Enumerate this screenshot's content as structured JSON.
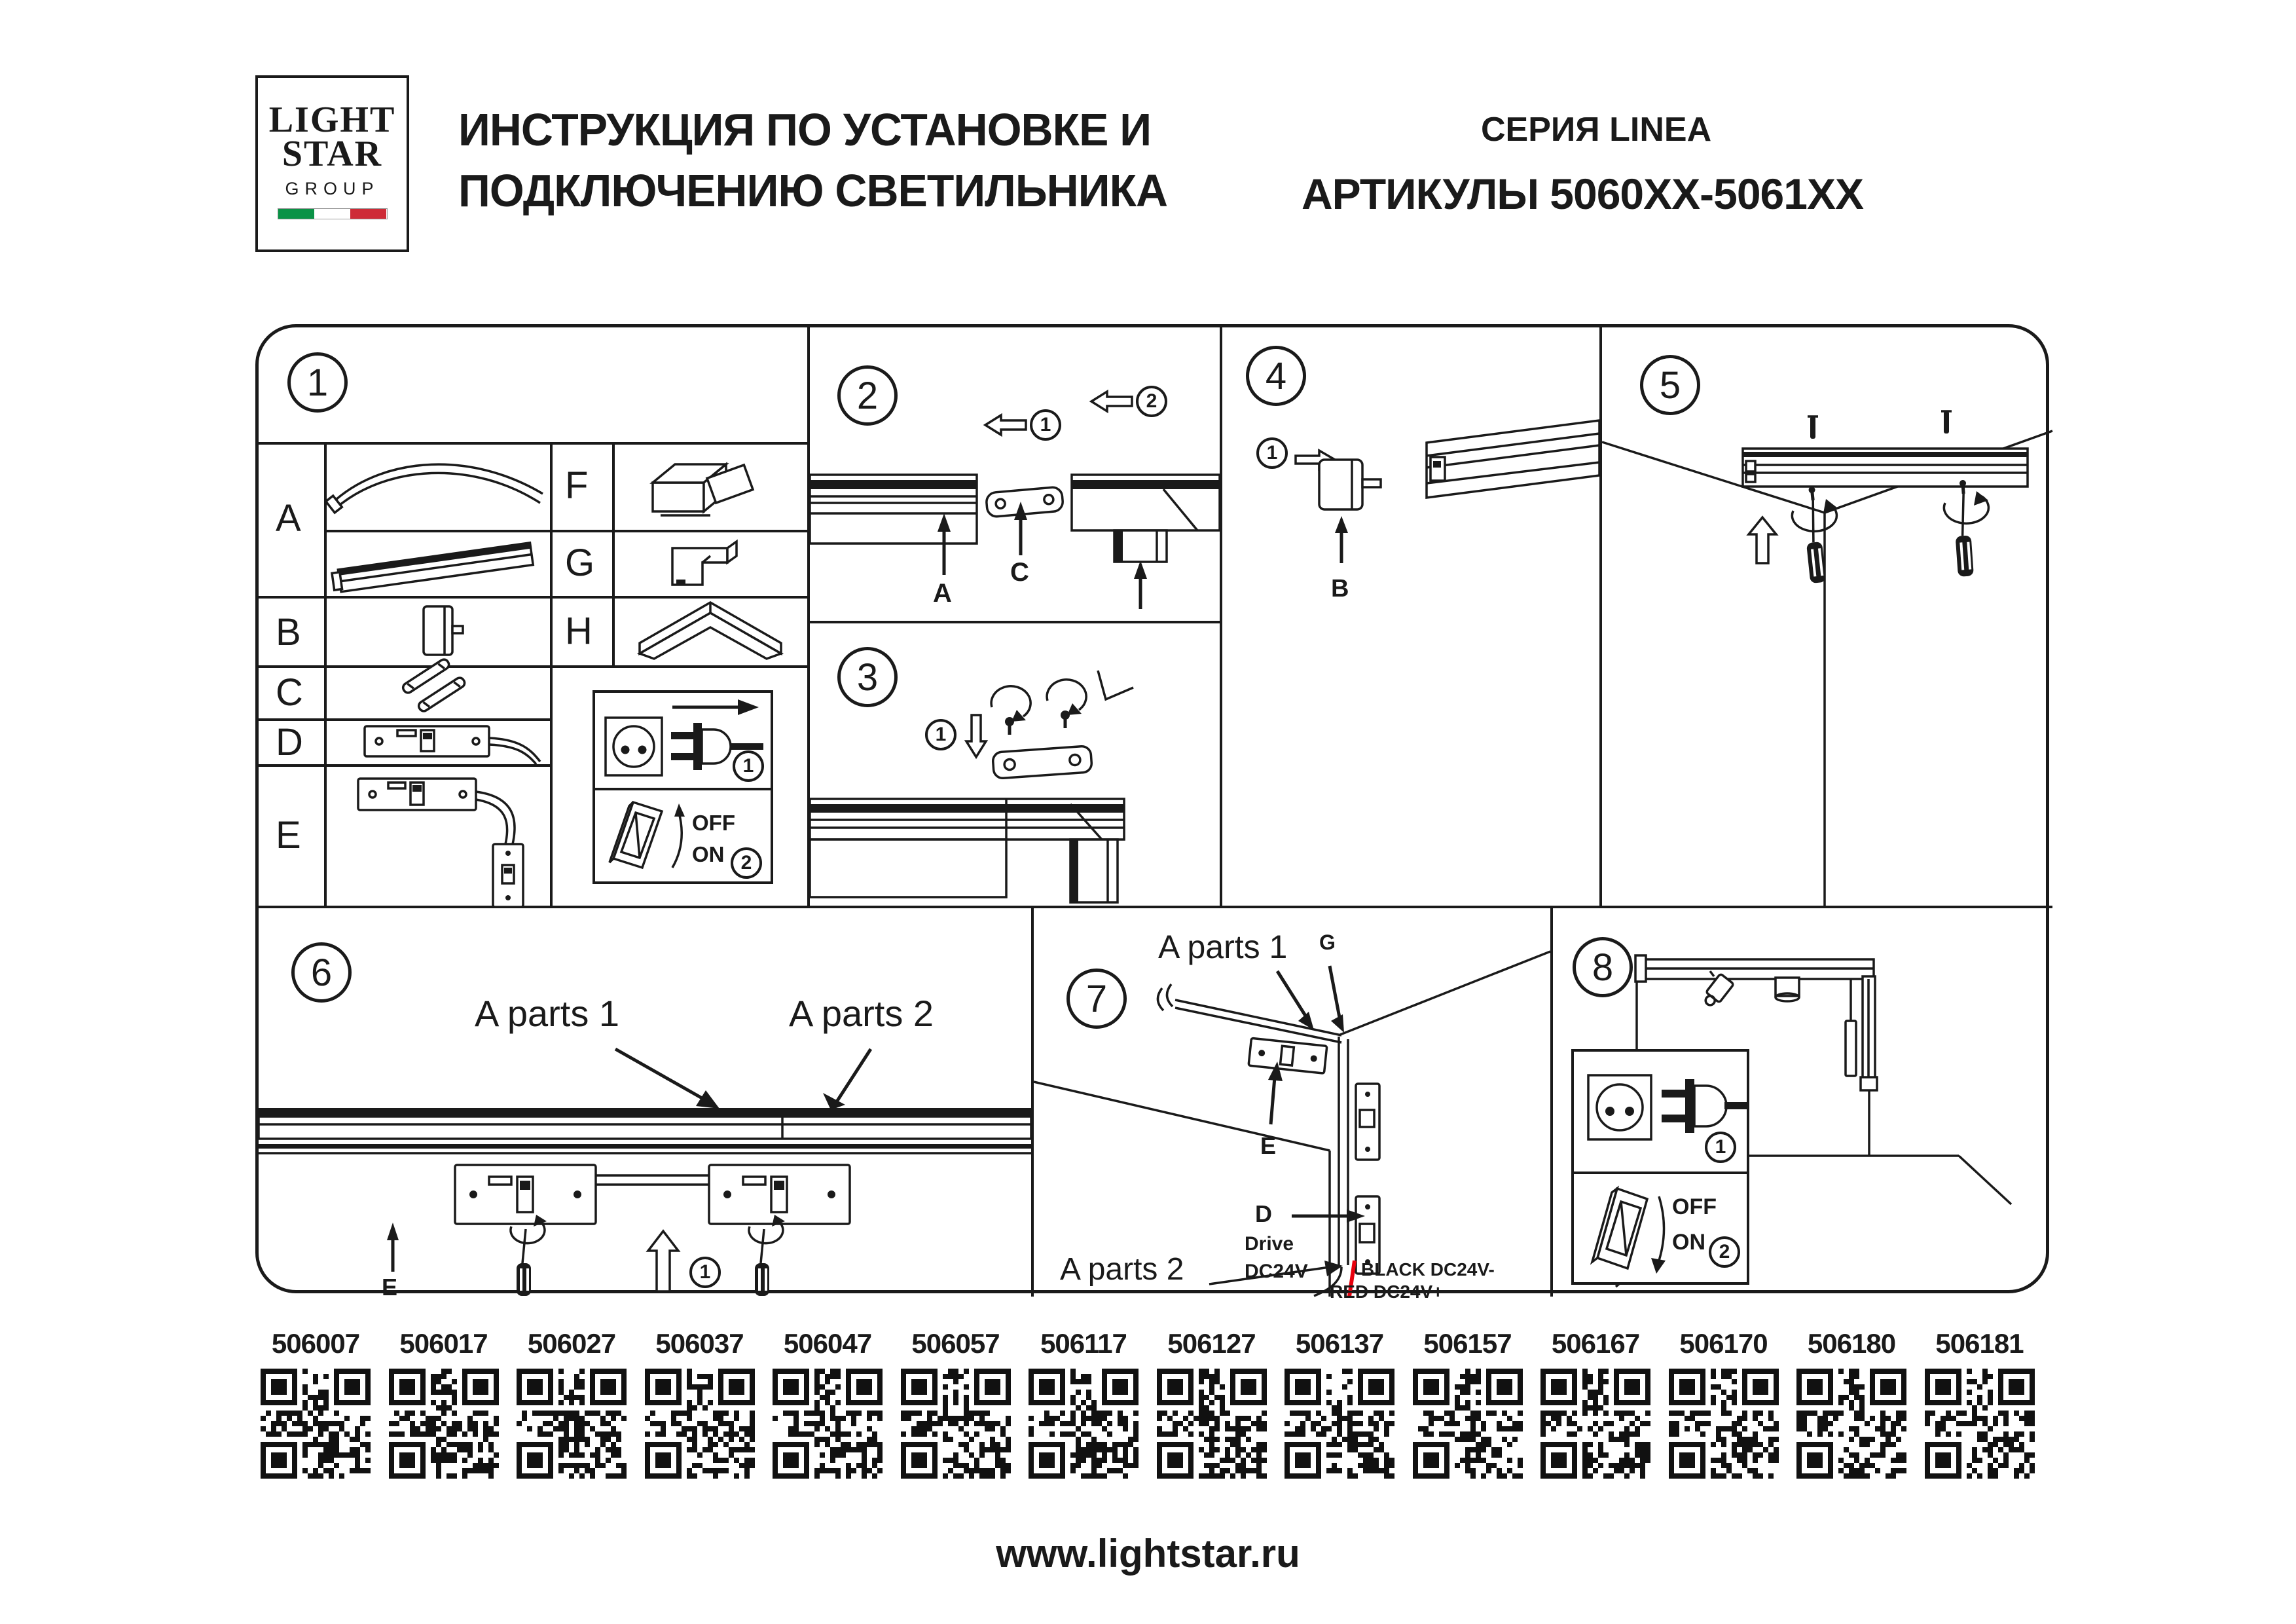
{
  "header": {
    "logo": {
      "word1": "LIGHT",
      "word2": "STAR",
      "word3": "GROUP",
      "flag_green": "#0a9246",
      "flag_white": "#ffffff",
      "flag_red": "#ce2b37"
    },
    "title_line1": "ИНСТРУКЦИЯ ПО УСТАНОВКЕ И",
    "title_line2": "ПОДКЛЮЧЕНИЮ СВЕТИЛЬНИКА",
    "series": "СЕРИЯ LINEA",
    "articles": "АРТИКУЛЫ 5060XX-5061XX"
  },
  "panel1": {
    "number": "1",
    "labels": {
      "a": "A",
      "b": "B",
      "c": "C",
      "d": "D",
      "e": "E",
      "f": "F",
      "g": "G",
      "h": "H"
    },
    "power": {
      "step1": "1",
      "step2": "2",
      "off": "OFF",
      "on": "ON"
    }
  },
  "panel2": {
    "number": "2",
    "step1": "1",
    "step2": "2",
    "label_a": "A",
    "label_c": "C"
  },
  "panel3": {
    "number": "3",
    "step1": "1"
  },
  "panel4": {
    "number": "4",
    "step1": "1",
    "label_b": "B"
  },
  "panel5": {
    "number": "5"
  },
  "panel6": {
    "number": "6",
    "label_parts1": "A parts 1",
    "label_parts2": "A parts 2",
    "label_e": "E",
    "step1": "1"
  },
  "panel7": {
    "number": "7",
    "label_parts1": "A parts 1",
    "label_parts2": "A parts 2",
    "label_g": "G",
    "label_e": "E",
    "label_d": "D",
    "drive1": "Drive",
    "drive2": "DC24V",
    "wire1": "BLACK DC24V-",
    "wire2": "RED DC24V+",
    "wire_red_color": "#e8000d"
  },
  "panel8": {
    "number": "8",
    "step1": "1",
    "step2": "2",
    "off": "OFF",
    "on": "ON"
  },
  "qr_codes": [
    "506007",
    "506017",
    "506027",
    "506037",
    "506047",
    "506057",
    "506117",
    "506127",
    "506137",
    "506157",
    "506167",
    "506170",
    "506180",
    "506181"
  ],
  "footer": {
    "url": "www.lightstar.ru"
  }
}
